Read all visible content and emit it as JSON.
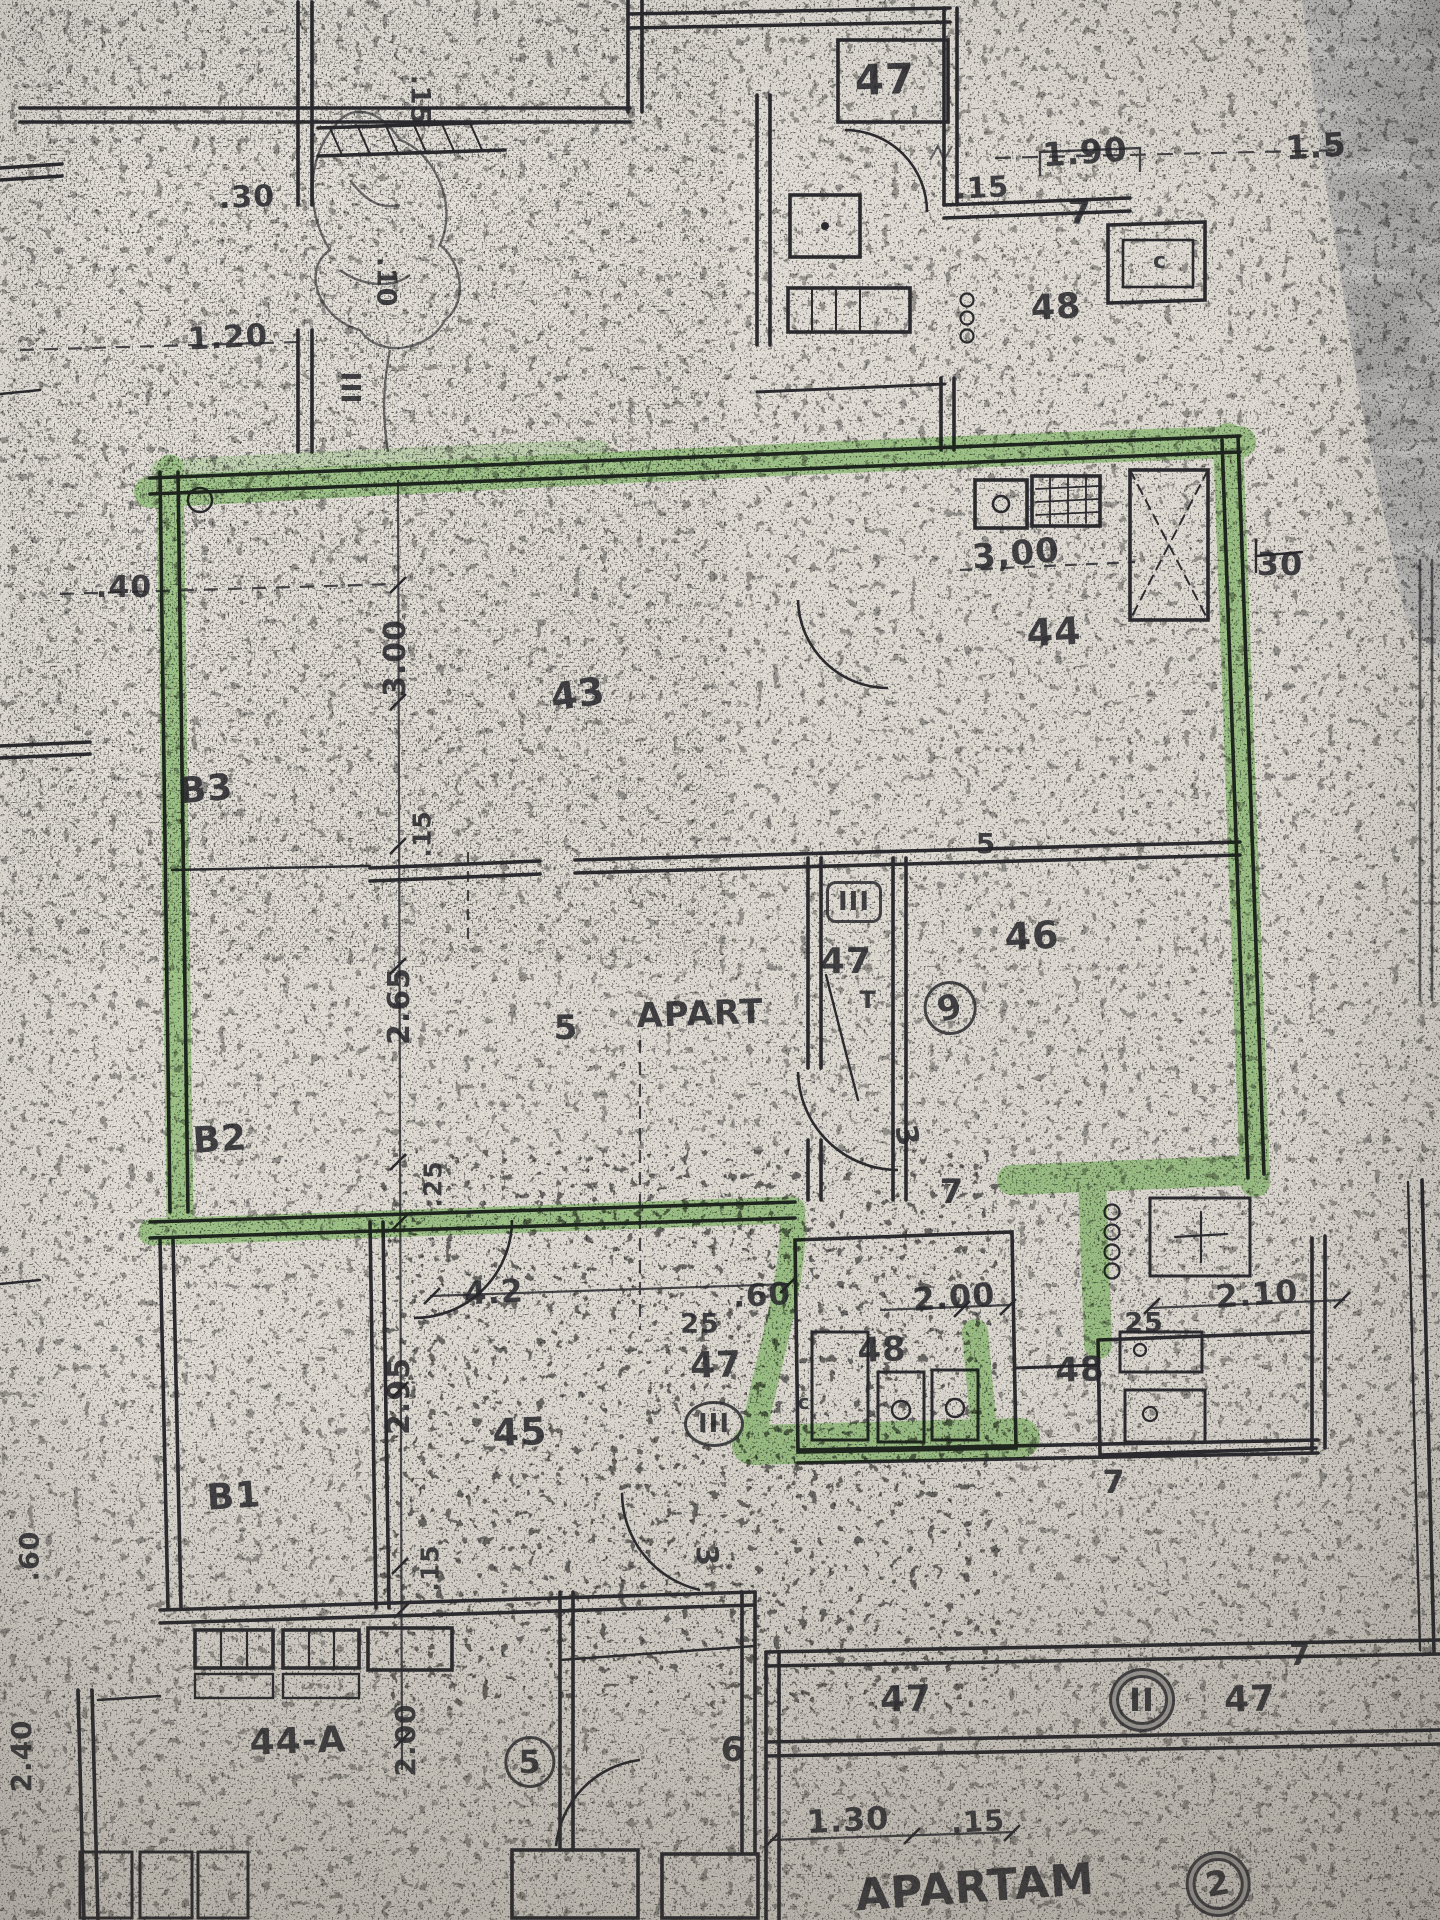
{
  "document": {
    "kind": "scanned floor plan photo with green highlighter outline",
    "highlighted_unit_text": "5 APART",
    "bottom_title": "APARTAM"
  },
  "colors": {
    "paper": "#e7e3db",
    "ink": "#2a2a2f",
    "highlighter": "#74c655",
    "table_surface": "#b5b4b2"
  },
  "annotations": [
    {
      "name": "room-label-47-top",
      "text": "47",
      "x": 885,
      "y": 80,
      "size": 42,
      "rot": -2
    },
    {
      "name": "dim-1-90",
      "text": "1.90",
      "x": 1085,
      "y": 152,
      "size": 33,
      "rot": -4
    },
    {
      "name": "dim-1-5",
      "text": "1.5",
      "x": 1316,
      "y": 146,
      "size": 33,
      "rot": -4
    },
    {
      "name": "dim-015-top",
      "text": ".15",
      "x": 982,
      "y": 188,
      "size": 29,
      "rot": -3
    },
    {
      "name": "dim-7-top",
      "text": "7",
      "x": 1080,
      "y": 212,
      "size": 33,
      "rot": 0
    },
    {
      "name": "room-label-48-top",
      "text": "48",
      "x": 1056,
      "y": 308,
      "size": 35,
      "rot": -3
    },
    {
      "name": "fixture-c-top",
      "text": "c",
      "x": 1160,
      "y": 262,
      "size": 22,
      "rot": 0
    },
    {
      "name": "dim-030",
      "text": ".30",
      "x": 247,
      "y": 198,
      "size": 30,
      "rot": -2
    },
    {
      "name": "dim-015-vert-top",
      "text": ".15",
      "x": 420,
      "y": 100,
      "size": 27,
      "rot": 90
    },
    {
      "name": "dim-010-vert",
      "text": ".10",
      "x": 386,
      "y": 282,
      "size": 27,
      "rot": 90
    },
    {
      "name": "dim-1-20",
      "text": "1.20",
      "x": 228,
      "y": 338,
      "size": 31,
      "rot": -3
    },
    {
      "name": "marker-iii-top",
      "text": "III",
      "x": 350,
      "y": 388,
      "size": 27,
      "rot": 90
    },
    {
      "name": "dim-3-00-kitchen",
      "text": "3,00",
      "x": 1016,
      "y": 554,
      "size": 34,
      "rot": -5
    },
    {
      "name": "dim-30-right",
      "text": "30",
      "x": 1280,
      "y": 564,
      "size": 32,
      "rot": 0
    },
    {
      "name": "room-label-44",
      "text": "44",
      "x": 1054,
      "y": 632,
      "size": 38,
      "rot": -3
    },
    {
      "name": "dim-040",
      "text": ".40",
      "x": 124,
      "y": 588,
      "size": 30,
      "rot": 0
    },
    {
      "name": "dim-3-00-vert",
      "text": "3.00",
      "x": 396,
      "y": 658,
      "size": 30,
      "rot": -90
    },
    {
      "name": "room-label-43",
      "text": "43",
      "x": 578,
      "y": 694,
      "size": 38,
      "rot": -8
    },
    {
      "name": "room-label-b3",
      "text": "B3",
      "x": 206,
      "y": 790,
      "size": 36,
      "rot": -5
    },
    {
      "name": "dim-015-vert-mid",
      "text": ".15",
      "x": 422,
      "y": 834,
      "size": 25,
      "rot": -90
    },
    {
      "name": "dim-5-small",
      "text": "5",
      "x": 986,
      "y": 844,
      "size": 28,
      "rot": 0
    },
    {
      "name": "room-label-46",
      "text": "46",
      "x": 1032,
      "y": 936,
      "size": 38,
      "rot": -3
    },
    {
      "name": "marker-iii-mid",
      "text": "III",
      "x": 854,
      "y": 902,
      "size": 26,
      "rot": 0,
      "mark": "square"
    },
    {
      "name": "room-label-47-mid",
      "text": "47",
      "x": 846,
      "y": 962,
      "size": 36,
      "rot": 0
    },
    {
      "name": "apartment-number",
      "text": "5",
      "x": 566,
      "y": 1028,
      "size": 34,
      "rot": 0
    },
    {
      "name": "apartment-text",
      "text": "APART",
      "x": 700,
      "y": 1014,
      "size": 34,
      "rot": -2
    },
    {
      "name": "apartment-text-t",
      "text": "T",
      "x": 868,
      "y": 1000,
      "size": 24,
      "rot": 0
    },
    {
      "name": "marker-9-circle",
      "text": "9",
      "x": 950,
      "y": 1008,
      "size": 34,
      "rot": -15,
      "mark": "circle"
    },
    {
      "name": "dim-2-65-vert",
      "text": "2.65",
      "x": 400,
      "y": 1006,
      "size": 30,
      "rot": -90
    },
    {
      "name": "room-label-b2",
      "text": "B2",
      "x": 220,
      "y": 1140,
      "size": 36,
      "rot": -4
    },
    {
      "name": "dim-025-vert",
      "text": ".25",
      "x": 433,
      "y": 1184,
      "size": 25,
      "rot": -90
    },
    {
      "name": "dim-3-door",
      "text": "3",
      "x": 906,
      "y": 1136,
      "size": 30,
      "rot": 80
    },
    {
      "name": "dim-7-mid",
      "text": "7",
      "x": 952,
      "y": 1192,
      "size": 34,
      "rot": 0
    },
    {
      "name": "dim-4-2",
      "text": "4.2",
      "x": 494,
      "y": 1292,
      "size": 32,
      "rot": -3
    },
    {
      "name": "dim-060-bottom",
      "text": ".60",
      "x": 762,
      "y": 1296,
      "size": 31,
      "rot": -3
    },
    {
      "name": "dim-25-left",
      "text": "25",
      "x": 700,
      "y": 1324,
      "size": 27,
      "rot": 0
    },
    {
      "name": "dim-2-00-bath",
      "text": "2.00",
      "x": 954,
      "y": 1297,
      "size": 32,
      "rot": -4
    },
    {
      "name": "room-label-48-left",
      "text": "48",
      "x": 882,
      "y": 1350,
      "size": 34,
      "rot": -2
    },
    {
      "name": "dim-25-right",
      "text": "25",
      "x": 1144,
      "y": 1323,
      "size": 27,
      "rot": 0
    },
    {
      "name": "dim-2-10-bath",
      "text": "2.10",
      "x": 1257,
      "y": 1294,
      "size": 32,
      "rot": -4
    },
    {
      "name": "room-label-48-right",
      "text": "48",
      "x": 1080,
      "y": 1370,
      "size": 34,
      "rot": -2
    },
    {
      "name": "fixture-c-bath",
      "text": "c",
      "x": 804,
      "y": 1402,
      "size": 20,
      "rot": 0
    },
    {
      "name": "room-label-47-bottom",
      "text": "47",
      "x": 716,
      "y": 1366,
      "size": 36,
      "rot": -2
    },
    {
      "name": "marker-iii-bottom",
      "text": "III",
      "x": 714,
      "y": 1424,
      "size": 26,
      "rot": 0,
      "mark": "circle"
    },
    {
      "name": "dim-7-bath",
      "text": "7",
      "x": 1114,
      "y": 1482,
      "size": 32,
      "rot": 0
    },
    {
      "name": "dim-2-95-vert",
      "text": "2.95",
      "x": 400,
      "y": 1396,
      "size": 30,
      "rot": -90
    },
    {
      "name": "room-label-45",
      "text": "45",
      "x": 520,
      "y": 1432,
      "size": 38,
      "rot": -2
    },
    {
      "name": "room-label-b1",
      "text": "B1",
      "x": 234,
      "y": 1497,
      "size": 36,
      "rot": -4
    },
    {
      "name": "dim-3-lower",
      "text": "3",
      "x": 706,
      "y": 1556,
      "size": 30,
      "rot": 85
    },
    {
      "name": "dim-015-vert-low",
      "text": ".15",
      "x": 430,
      "y": 1568,
      "size": 25,
      "rot": -90
    },
    {
      "name": "dim-060-vert-left",
      "text": ".60",
      "x": 30,
      "y": 1556,
      "size": 27,
      "rot": -90
    },
    {
      "name": "dim-2-40-vert-left",
      "text": "2.40",
      "x": 22,
      "y": 1756,
      "size": 28,
      "rot": -90
    },
    {
      "name": "room-label-44a",
      "text": "44-A",
      "x": 298,
      "y": 1742,
      "size": 36,
      "rot": -2
    },
    {
      "name": "dim-2-00-vert-left",
      "text": "2.00",
      "x": 406,
      "y": 1740,
      "size": 28,
      "rot": -90
    },
    {
      "name": "marker-5-circle",
      "text": "5",
      "x": 530,
      "y": 1762,
      "size": 32,
      "rot": 0,
      "mark": "circle"
    },
    {
      "name": "dim-6",
      "text": "6",
      "x": 733,
      "y": 1750,
      "size": 34,
      "rot": 0
    },
    {
      "name": "room-label-47-br-left",
      "text": "47",
      "x": 906,
      "y": 1700,
      "size": 36,
      "rot": -2
    },
    {
      "name": "marker-ii-circle",
      "text": "II",
      "x": 1142,
      "y": 1700,
      "size": 32,
      "rot": 0,
      "mark": "circle-double"
    },
    {
      "name": "room-label-47-br-right",
      "text": "47",
      "x": 1250,
      "y": 1700,
      "size": 36,
      "rot": -2
    },
    {
      "name": "dim-7-br",
      "text": "7",
      "x": 1300,
      "y": 1656,
      "size": 30,
      "rot": 0
    },
    {
      "name": "dim-1-30",
      "text": "1.30",
      "x": 848,
      "y": 1820,
      "size": 32,
      "rot": -3
    },
    {
      "name": "dim-015-bottom",
      "text": ".15",
      "x": 978,
      "y": 1822,
      "size": 29,
      "rot": -3
    },
    {
      "name": "apartment-2-text",
      "text": "APARTAM",
      "x": 975,
      "y": 1888,
      "size": 44,
      "rot": -4
    },
    {
      "name": "marker-2-circle",
      "text": "2",
      "x": 1218,
      "y": 1884,
      "size": 34,
      "rot": -10,
      "mark": "circle-double"
    }
  ]
}
